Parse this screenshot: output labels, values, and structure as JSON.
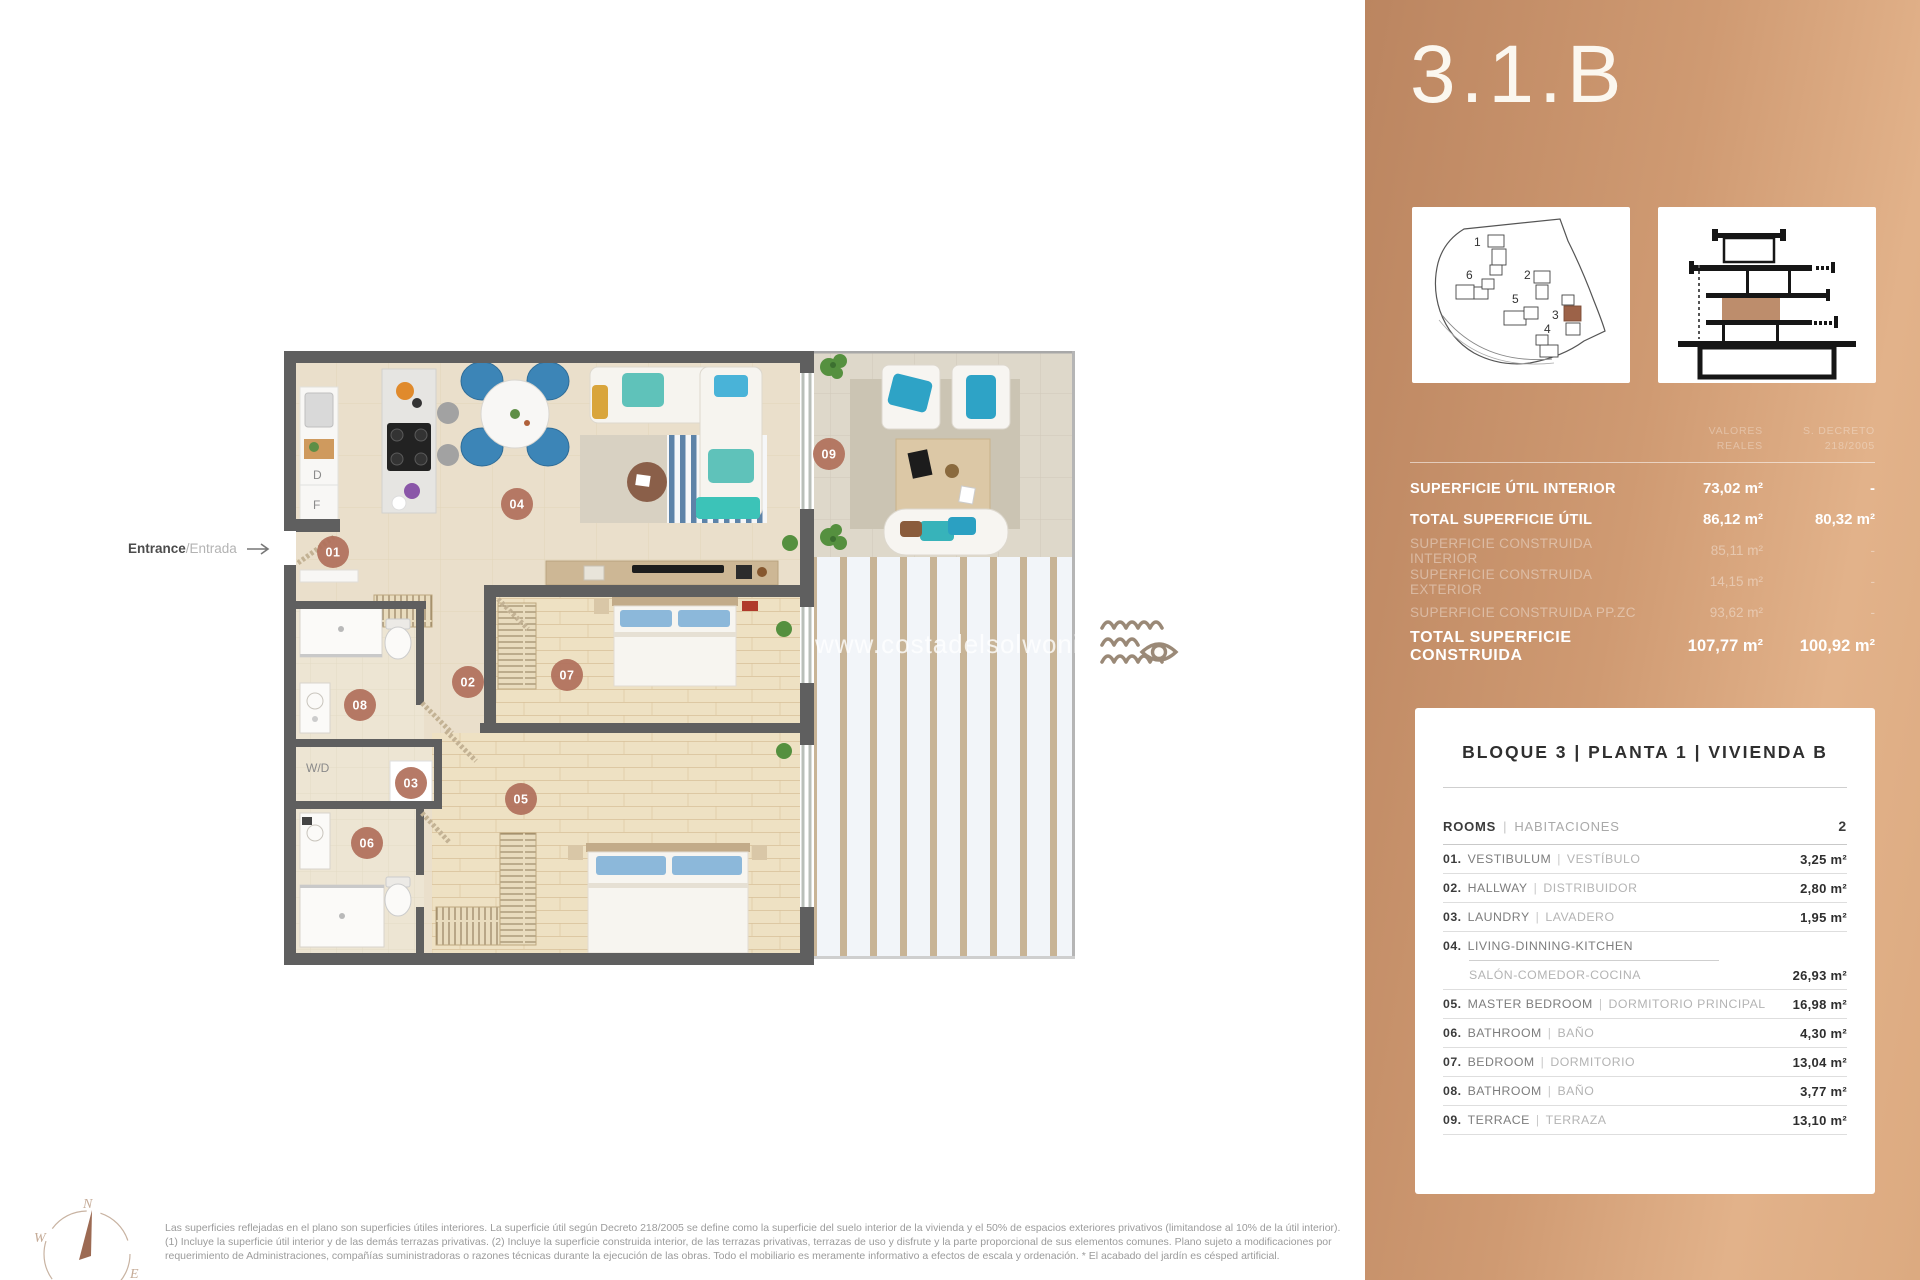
{
  "panel": {
    "unit_title": "3.1.B",
    "columns": [
      {
        "l1": "VALORES",
        "l2": "REALES"
      },
      {
        "l1": "S. DECRETO",
        "l2": "218/2005"
      }
    ],
    "surface_rows": [
      {
        "label": "SUPERFICIE ÚTIL INTERIOR",
        "v1": "73,02 m²",
        "v2": "-",
        "emphasis": true
      },
      {
        "label": "TOTAL SUPERFICIE ÚTIL",
        "v1": "86,12 m²",
        "v2": "80,32 m²",
        "emphasis": true
      },
      {
        "label": "SUPERFICIE CONSTRUIDA INTERIOR",
        "v1": "85,11 m²",
        "v2": "-",
        "emphasis": false
      },
      {
        "label": "SUPERFICIE CONSTRUIDA EXTERIOR",
        "v1": "14,15 m²",
        "v2": "-",
        "emphasis": false
      },
      {
        "label": "SUPERFICIE CONSTRUIDA PP.ZC",
        "v1": "93,62 m²",
        "v2": "-",
        "emphasis": false
      },
      {
        "label": "TOTAL SUPERFICIE CONSTRUIDA",
        "v1": "107,77 m²",
        "v2": "100,92 m²",
        "emphasis": true,
        "total": true
      }
    ],
    "card": {
      "title": "BLOQUE 3  |  PLANTA 1  |  VIVIENDA B",
      "rooms_label": "ROOMS",
      "rooms_label_es": "HABITACIONES",
      "rooms_count": "2",
      "sep": "|",
      "rooms": [
        {
          "num": "01.",
          "en": "VESTIBULUM",
          "es": "VESTÍBULO",
          "area": "3,25 m²"
        },
        {
          "num": "02.",
          "en": "HALLWAY",
          "es": "DISTRIBUIDOR",
          "area": "2,80 m²"
        },
        {
          "num": "03.",
          "en": "LAUNDRY",
          "es": "LAVADERO",
          "area": "1,95 m²"
        },
        {
          "num": "04.",
          "en": "LIVING-DINNING-KITCHEN",
          "es": "SALÓN-COMEDOR-COCINA",
          "area": "26,93 m²",
          "two_line": true
        },
        {
          "num": "05.",
          "en": "MASTER BEDROOM",
          "es": "DORMITORIO PRINCIPAL",
          "area": "16,98 m²"
        },
        {
          "num": "06.",
          "en": "BATHROOM",
          "es": "BAÑO",
          "area": "4,30 m²"
        },
        {
          "num": "07.",
          "en": "BEDROOM",
          "es": "DORMITORIO",
          "area": "13,04 m²"
        },
        {
          "num": "08.",
          "en": "BATHROOM",
          "es": "BAÑO",
          "area": "3,77 m²"
        },
        {
          "num": "09.",
          "en": "TERRACE",
          "es": "TERRAZA",
          "area": "13,10 m²"
        }
      ]
    }
  },
  "site_plan": {
    "numbers": [
      "1",
      "2",
      "3",
      "4",
      "5",
      "6"
    ],
    "highlighted": "3"
  },
  "plan": {
    "badges": [
      "01",
      "02",
      "03",
      "04",
      "05",
      "06",
      "07",
      "08",
      "09"
    ],
    "labels": {
      "d": "D",
      "f": "F",
      "wd": "W/D"
    },
    "watermark": "www.costadelsolwoningen",
    "entrance": {
      "en": "Entrance",
      "es": "/Entrada"
    }
  },
  "compass": {
    "n": "N",
    "e": "E",
    "s": "S",
    "w": "W"
  },
  "footer": {
    "disclaimer": "Las superficies reflejadas en el plano son superficies útiles interiores. La superficie útil según Decreto 218/2005 se define como la superficie del suelo interior de la vivienda y el 50% de espacios exteriores privativos (limitandose al 10% de la útil interior). (1) Incluye la superficie útil interior y de las demás terrazas privativas. (2) Incluye la superficie construida interior, de las terrazas privativas, terrazas de uso y disfrute y la parte proporcional de sus elementos comunes. Plano sujeto a modificaciones por requerimiento de Administraciones, compañías suministradoras o razones técnicas durante la ejecución de las obras. Todo el mobiliario es meramente informativo a efectos de escala y ordenación. * El acabado del jardín es césped artificial."
  },
  "colors": {
    "accent_badge": "#b0705b",
    "panel_start": "#bb8560",
    "panel_end": "#dcaa80",
    "highlight_brown": "#9c6248"
  }
}
